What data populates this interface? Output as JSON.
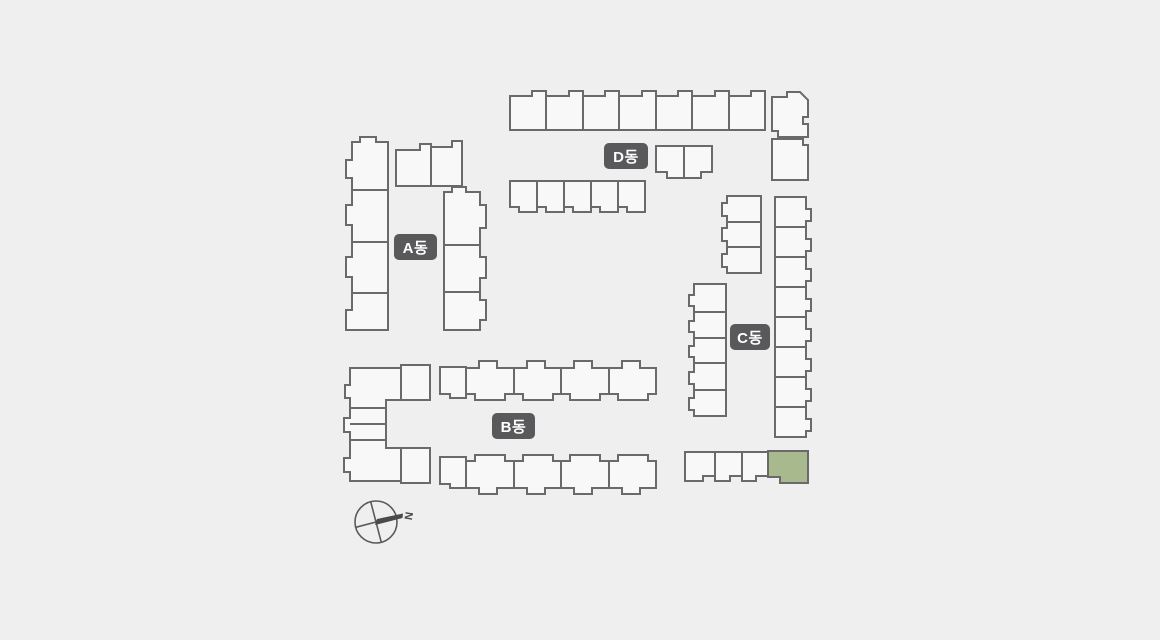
{
  "background": "#efefef",
  "colors": {
    "stroke": "#6a6a6a",
    "unit_fill": "#f8f8f8",
    "highlight_fill": "#a8b98e",
    "label_bg": "#59595b",
    "label_text": "#ffffff",
    "compass": "#5a5a5a"
  },
  "compass": {
    "label": "N"
  },
  "buildings": [
    {
      "id": "A",
      "label": "A동",
      "label_box": {
        "x": 394,
        "y": 234,
        "w": 43,
        "h": 26
      },
      "units": [
        {
          "d": "M352,142 L360,142 L360,137 L376,137 L376,142 L388,142 L388,190 L352,190 L352,178 L346,178 L346,160 L352,160 Z"
        },
        {
          "d": "M352,190 L388,190 L388,242 L352,242 L352,225 L346,225 L346,205 L352,205 Z"
        },
        {
          "d": "M352,242 L388,242 L388,293 L352,293 L352,277 L346,277 L346,257 L352,257 Z"
        },
        {
          "d": "M352,293 L388,293 L388,330 L346,330 L346,310 L352,310 Z"
        },
        {
          "d": "M396,150 L420,150 L420,144 L431,144 L431,186 L396,186 Z"
        },
        {
          "d": "M431,147 L452,147 L452,141 L462,141 L462,186 L431,186 Z"
        },
        {
          "d": "M444,192 L452,192 L452,187 L466,187 L466,192 L480,192 L480,205 L486,205 L486,228 L480,228 L480,245 L444,245 Z"
        },
        {
          "d": "M444,245 L480,245 L480,257 L486,257 L486,278 L480,278 L480,292 L444,292 Z"
        },
        {
          "d": "M444,292 L480,292 L480,300 L486,300 L486,320 L480,320 L480,330 L444,330 Z"
        }
      ]
    },
    {
      "id": "B",
      "label": "B동",
      "label_box": {
        "x": 492,
        "y": 413,
        "w": 43,
        "h": 26
      },
      "units": [
        {
          "d": "M350,368 L401,368 L401,400 L386,400 L386,408 L350,408 L350,398 L345,398 L345,385 L350,385 Z"
        },
        {
          "d": "M401,365 L430,365 L430,400 L401,400 Z"
        },
        {
          "d": "M350,408 L386,408 L386,440 L350,440 L350,432 L344,432 L344,418 L350,418 Z"
        },
        {
          "d": "M350,424 L386,424",
          "line": true
        },
        {
          "d": "M350,440 L386,440 L386,448 L401,448 L401,481 L350,481 L350,472 L344,472 L344,458 L350,458 Z"
        },
        {
          "d": "M401,448 L430,448 L430,483 L401,483 Z"
        },
        {
          "d": "M440,367 L466,367 L466,398 L450,398 L450,394 L440,394 Z"
        },
        {
          "d": "M466,368 L479,368 L479,361 L497,361 L497,368 L514,368 L514,394 L505,394 L505,400 L475,400 L475,394 L466,394 Z"
        },
        {
          "d": "M514,368 L527,368 L527,361 L545,361 L545,368 L561,368 L561,394 L553,394 L553,400 L523,400 L523,394 L514,394 Z"
        },
        {
          "d": "M561,368 L574,368 L574,361 L592,361 L592,368 L609,368 L609,394 L600,394 L600,400 L570,400 L570,394 L561,394 Z"
        },
        {
          "d": "M609,368 L622,368 L622,361 L640,361 L640,368 L656,368 L656,394 L648,394 L648,400 L618,400 L618,394 L609,394 Z"
        },
        {
          "d": "M440,457 L466,457 L466,488 L450,488 L450,484 L440,484 Z"
        },
        {
          "d": "M466,461 L475,461 L475,455 L505,455 L505,461 L514,461 L514,488 L497,488 L497,494 L479,494 L479,488 L466,488 Z"
        },
        {
          "d": "M514,461 L523,461 L523,455 L553,455 L553,461 L561,461 L561,488 L545,488 L545,494 L527,494 L527,488 L514,488 Z"
        },
        {
          "d": "M561,461 L570,461 L570,455 L600,455 L600,461 L609,461 L609,488 L592,488 L592,494 L574,494 L574,488 L561,488 Z"
        },
        {
          "d": "M609,461 L618,461 L618,455 L648,455 L648,461 L656,461 L656,488 L640,488 L640,494 L622,494 L622,488 L609,488 Z"
        }
      ]
    },
    {
      "id": "C",
      "label": "C동",
      "label_box": {
        "x": 730,
        "y": 324,
        "w": 40,
        "h": 26
      },
      "units": [
        {
          "d": "M727,196 L761,196 L761,222 L727,222 L727,216 L722,216 L722,203 L727,203 Z"
        },
        {
          "d": "M727,222 L761,222 L761,247 L727,247 L727,241 L722,241 L722,228 L727,228 Z"
        },
        {
          "d": "M727,247 L761,247 L761,273 L727,273 L727,267 L722,267 L722,254 L727,254 Z"
        },
        {
          "d": "M694,284 L726,284 L726,312 L694,312 L694,306 L689,306 L689,295 L694,295 Z"
        },
        {
          "d": "M694,312 L726,312 L726,338 L694,338 L694,332 L689,332 L689,321 L694,321 Z"
        },
        {
          "d": "M694,338 L726,338 L726,363 L694,363 L694,357 L689,357 L689,346 L694,346 Z"
        },
        {
          "d": "M694,363 L726,363 L726,390 L694,390 L694,384 L689,384 L689,372 L694,372 Z"
        },
        {
          "d": "M694,390 L726,390 L726,416 L694,416 L694,410 L689,410 L689,398 L694,398 Z"
        },
        {
          "d": "M775,197 L806,197 L806,209 L811,209 L811,221 L806,221 L806,227 L775,227 Z"
        },
        {
          "d": "M775,227 L806,227 L806,239 L811,239 L811,251 L806,251 L806,257 L775,257 Z"
        },
        {
          "d": "M775,257 L806,257 L806,269 L811,269 L811,281 L806,281 L806,287 L775,287 Z"
        },
        {
          "d": "M775,287 L806,287 L806,299 L811,299 L811,311 L806,311 L806,317 L775,317 Z"
        },
        {
          "d": "M775,317 L806,317 L806,329 L811,329 L811,341 L806,341 L806,347 L775,347 Z"
        },
        {
          "d": "M775,347 L806,347 L806,359 L811,359 L811,371 L806,371 L806,377 L775,377 Z"
        },
        {
          "d": "M775,377 L806,377 L806,389 L811,389 L811,401 L806,401 L806,407 L775,407 Z"
        },
        {
          "d": "M775,407 L806,407 L806,419 L811,419 L811,431 L806,431 L806,437 L775,437 Z"
        },
        {
          "d": "M685,452 L715,452 L715,476 L703,476 L703,481 L685,481 Z"
        },
        {
          "d": "M715,452 L742,452 L742,476 L730,476 L730,481 L715,481 Z"
        },
        {
          "d": "M742,452 L768,452 L768,476 L756,476 L756,481 L742,481 Z"
        },
        {
          "d": "M768,451 L808,451 L808,483 L780,483 L780,477 L768,477 Z",
          "highlight": true
        }
      ]
    },
    {
      "id": "D",
      "label": "D동",
      "label_box": {
        "x": 604,
        "y": 143,
        "w": 44,
        "h": 26
      },
      "units": [
        {
          "d": "M510,96 L532,96 L532,91 L546,91 L546,130 L510,130 Z"
        },
        {
          "d": "M546,96 L569,96 L569,91 L583,91 L583,130 L546,130 Z"
        },
        {
          "d": "M583,96 L605,96 L605,91 L619,91 L619,130 L583,130 Z"
        },
        {
          "d": "M619,96 L642,96 L642,91 L656,91 L656,130 L619,130 Z"
        },
        {
          "d": "M656,96 L678,96 L678,91 L692,91 L692,130 L656,130 Z"
        },
        {
          "d": "M692,96 L715,96 L715,91 L729,91 L729,130 L692,130 Z"
        },
        {
          "d": "M729,96 L751,96 L751,91 L765,91 L765,130 L729,130 Z"
        },
        {
          "d": "M772,97 L787,97 L787,92 L800,92 L808,100 L808,117 L803,117 L803,124 L808,124 L808,137 L778,137 L778,131 L772,131 Z"
        },
        {
          "d": "M772,139 L803,139 L803,145 L808,145 L808,180 L772,180 Z"
        },
        {
          "d": "M656,146 L684,146 L684,178 L667,178 L667,172 L656,172 Z"
        },
        {
          "d": "M684,146 L712,146 L712,172 L701,172 L701,178 L684,178 Z"
        },
        {
          "d": "M510,181 L537,181 L537,212 L519,212 L519,207 L510,207 Z"
        },
        {
          "d": "M537,181 L564,181 L564,212 L546,212 L546,207 L537,207 Z"
        },
        {
          "d": "M564,181 L591,181 L591,212 L573,212 L573,207 L564,207 Z"
        },
        {
          "d": "M591,181 L618,181 L618,212 L600,212 L600,207 L591,207 Z"
        },
        {
          "d": "M618,181 L645,181 L645,212 L627,212 L627,207 L618,207 Z"
        }
      ]
    }
  ]
}
